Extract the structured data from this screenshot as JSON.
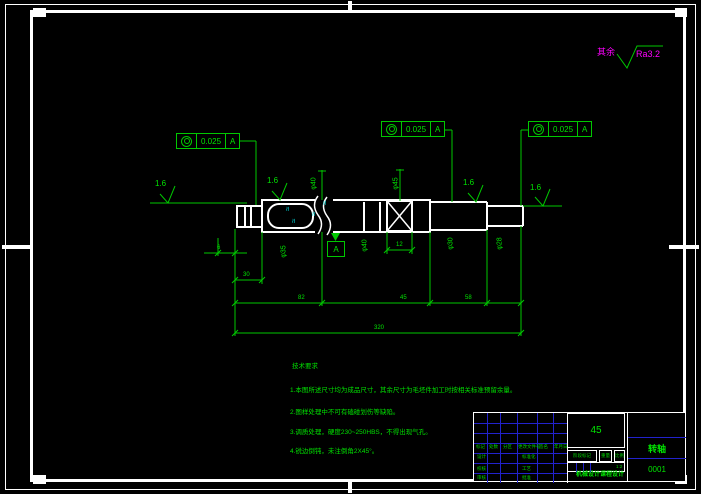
{
  "legend": {
    "rest_label": "其余",
    "roughness_value": "Ra3.2"
  },
  "fcf": [
    {
      "symbol": "concentricity-icon",
      "value": "0.025",
      "datum": "A"
    },
    {
      "symbol": "concentricity-icon",
      "value": "0.025",
      "datum": "A"
    },
    {
      "symbol": "concentricity-icon",
      "value": "0.025",
      "datum": "A"
    }
  ],
  "finish": {
    "values": [
      "1.6",
      "1.6",
      "1.6",
      "1.6"
    ]
  },
  "datum": {
    "label": "A"
  },
  "break_mark": "≈",
  "dims": {
    "d6": "6",
    "d30": "30",
    "d82": "82",
    "d45": "45",
    "d58": "58",
    "d320": "320",
    "d12": "12",
    "v1": "φ40",
    "v2": "φ45",
    "v3": "φ35",
    "v4": "φ40",
    "v5": "φ30",
    "v6": "φ28"
  },
  "notes": {
    "title": "技术要求",
    "items": [
      "1.本图所述尺寸均为成品尺寸，其余尺寸为毛坯件加工时按相关标准预留余量。",
      "2.图样处理中不可有磕碰划伤等缺陷。",
      "3.调质处理，硬度230~250HBS，不得出现气孔。",
      "4.锐边倒钝，未注倒角2X45°。"
    ]
  },
  "title_block": {
    "material": "45",
    "part_name": "转轴",
    "drawing_number": "0001",
    "row_fields": [
      "标记",
      "处数",
      "分区",
      "更改文件号",
      "签名",
      "年月日"
    ],
    "left_fields": [
      "设计",
      "校核",
      "审核"
    ],
    "mid_fields": [
      "标准化",
      "工艺",
      "批准"
    ],
    "stage_label": "阶段标记",
    "weight_label": "重量",
    "scale_label": "比例",
    "scale_value": "1:2",
    "org": "机械设计课程设计"
  }
}
